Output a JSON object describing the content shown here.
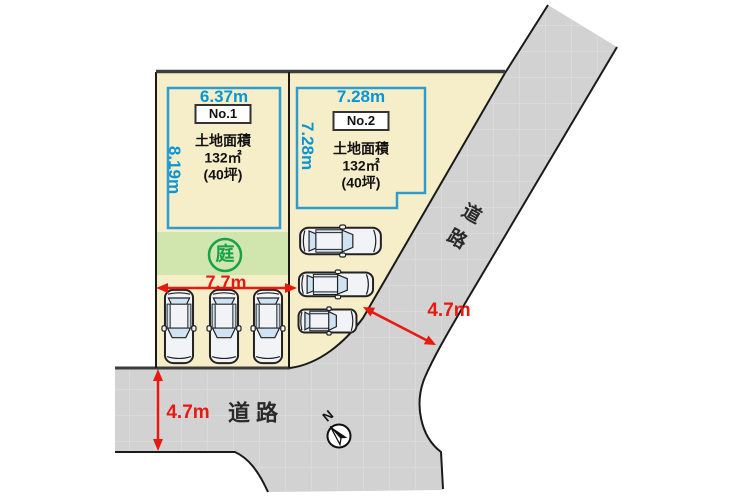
{
  "palette": {
    "lot_fill": "#f6eec9",
    "road_fill": "#d2d2d3",
    "garden_fill": "#d0e6ae",
    "accent_blue": "#0795d6",
    "accent_red": "#e8190f",
    "accent_green": "#17a24a",
    "line_dark": "#1a1a1a"
  },
  "lots": [
    {
      "id": "No.1",
      "width": "6.37m",
      "depth": "8.19m",
      "area_title": "土地面積",
      "area_value": "132㎡",
      "area_tsubo": "(40坪)"
    },
    {
      "id": "No.2",
      "width": "7.28m",
      "depth": "7.28m",
      "area_title": "土地面積",
      "area_value": "132㎡",
      "area_tsubo": "(40坪)"
    }
  ],
  "garden": {
    "label": "庭"
  },
  "parking": {
    "width": "7.7m"
  },
  "roads": {
    "side_label": "道路",
    "side_char1": "道",
    "side_char2": "路",
    "bottom_label": "道 路",
    "side_width": "4.7m",
    "bottom_width": "4.7m"
  },
  "compass": {
    "north": "N"
  }
}
